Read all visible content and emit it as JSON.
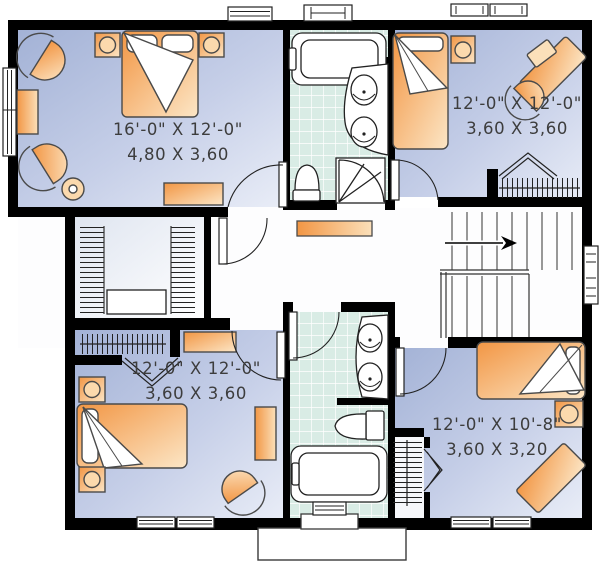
{
  "plan": {
    "type": "second-floor-house-plan",
    "rooms": [
      {
        "id": "bedroom-master",
        "imperial": "16'-0\" X 12'-0\"",
        "metric": "4,80 X 3,60"
      },
      {
        "id": "bedroom-top-right",
        "imperial": "12'-0\" X 12'-0\"",
        "metric": "3,60 X 3,60"
      },
      {
        "id": "bedroom-bottom-left",
        "imperial": "12'-0\" X 12'-0\"",
        "metric": "3,60 X 3,60"
      },
      {
        "id": "bedroom-bottom-right",
        "imperial": "12'-0\" X 10'-8\"",
        "metric": "3,60 X 3,20"
      }
    ],
    "fixtures": [
      "bathtub",
      "double-sink-vanity",
      "toilet",
      "shower-door",
      "staircase-up-arrow",
      "closet-shelving",
      "beds",
      "nightstand-lamps",
      "armchairs",
      "desks",
      "dressers"
    ],
    "colors": {
      "wall": "#000000",
      "room_floor_dark": "#a9b8da",
      "room_floor_light": "#e9edf7",
      "furniture_dark": "#f29644",
      "furniture_light": "#fce6c6",
      "bath_tile": "#d9ece5",
      "hall_floor": "#ffffff",
      "line": "#222222"
    }
  }
}
